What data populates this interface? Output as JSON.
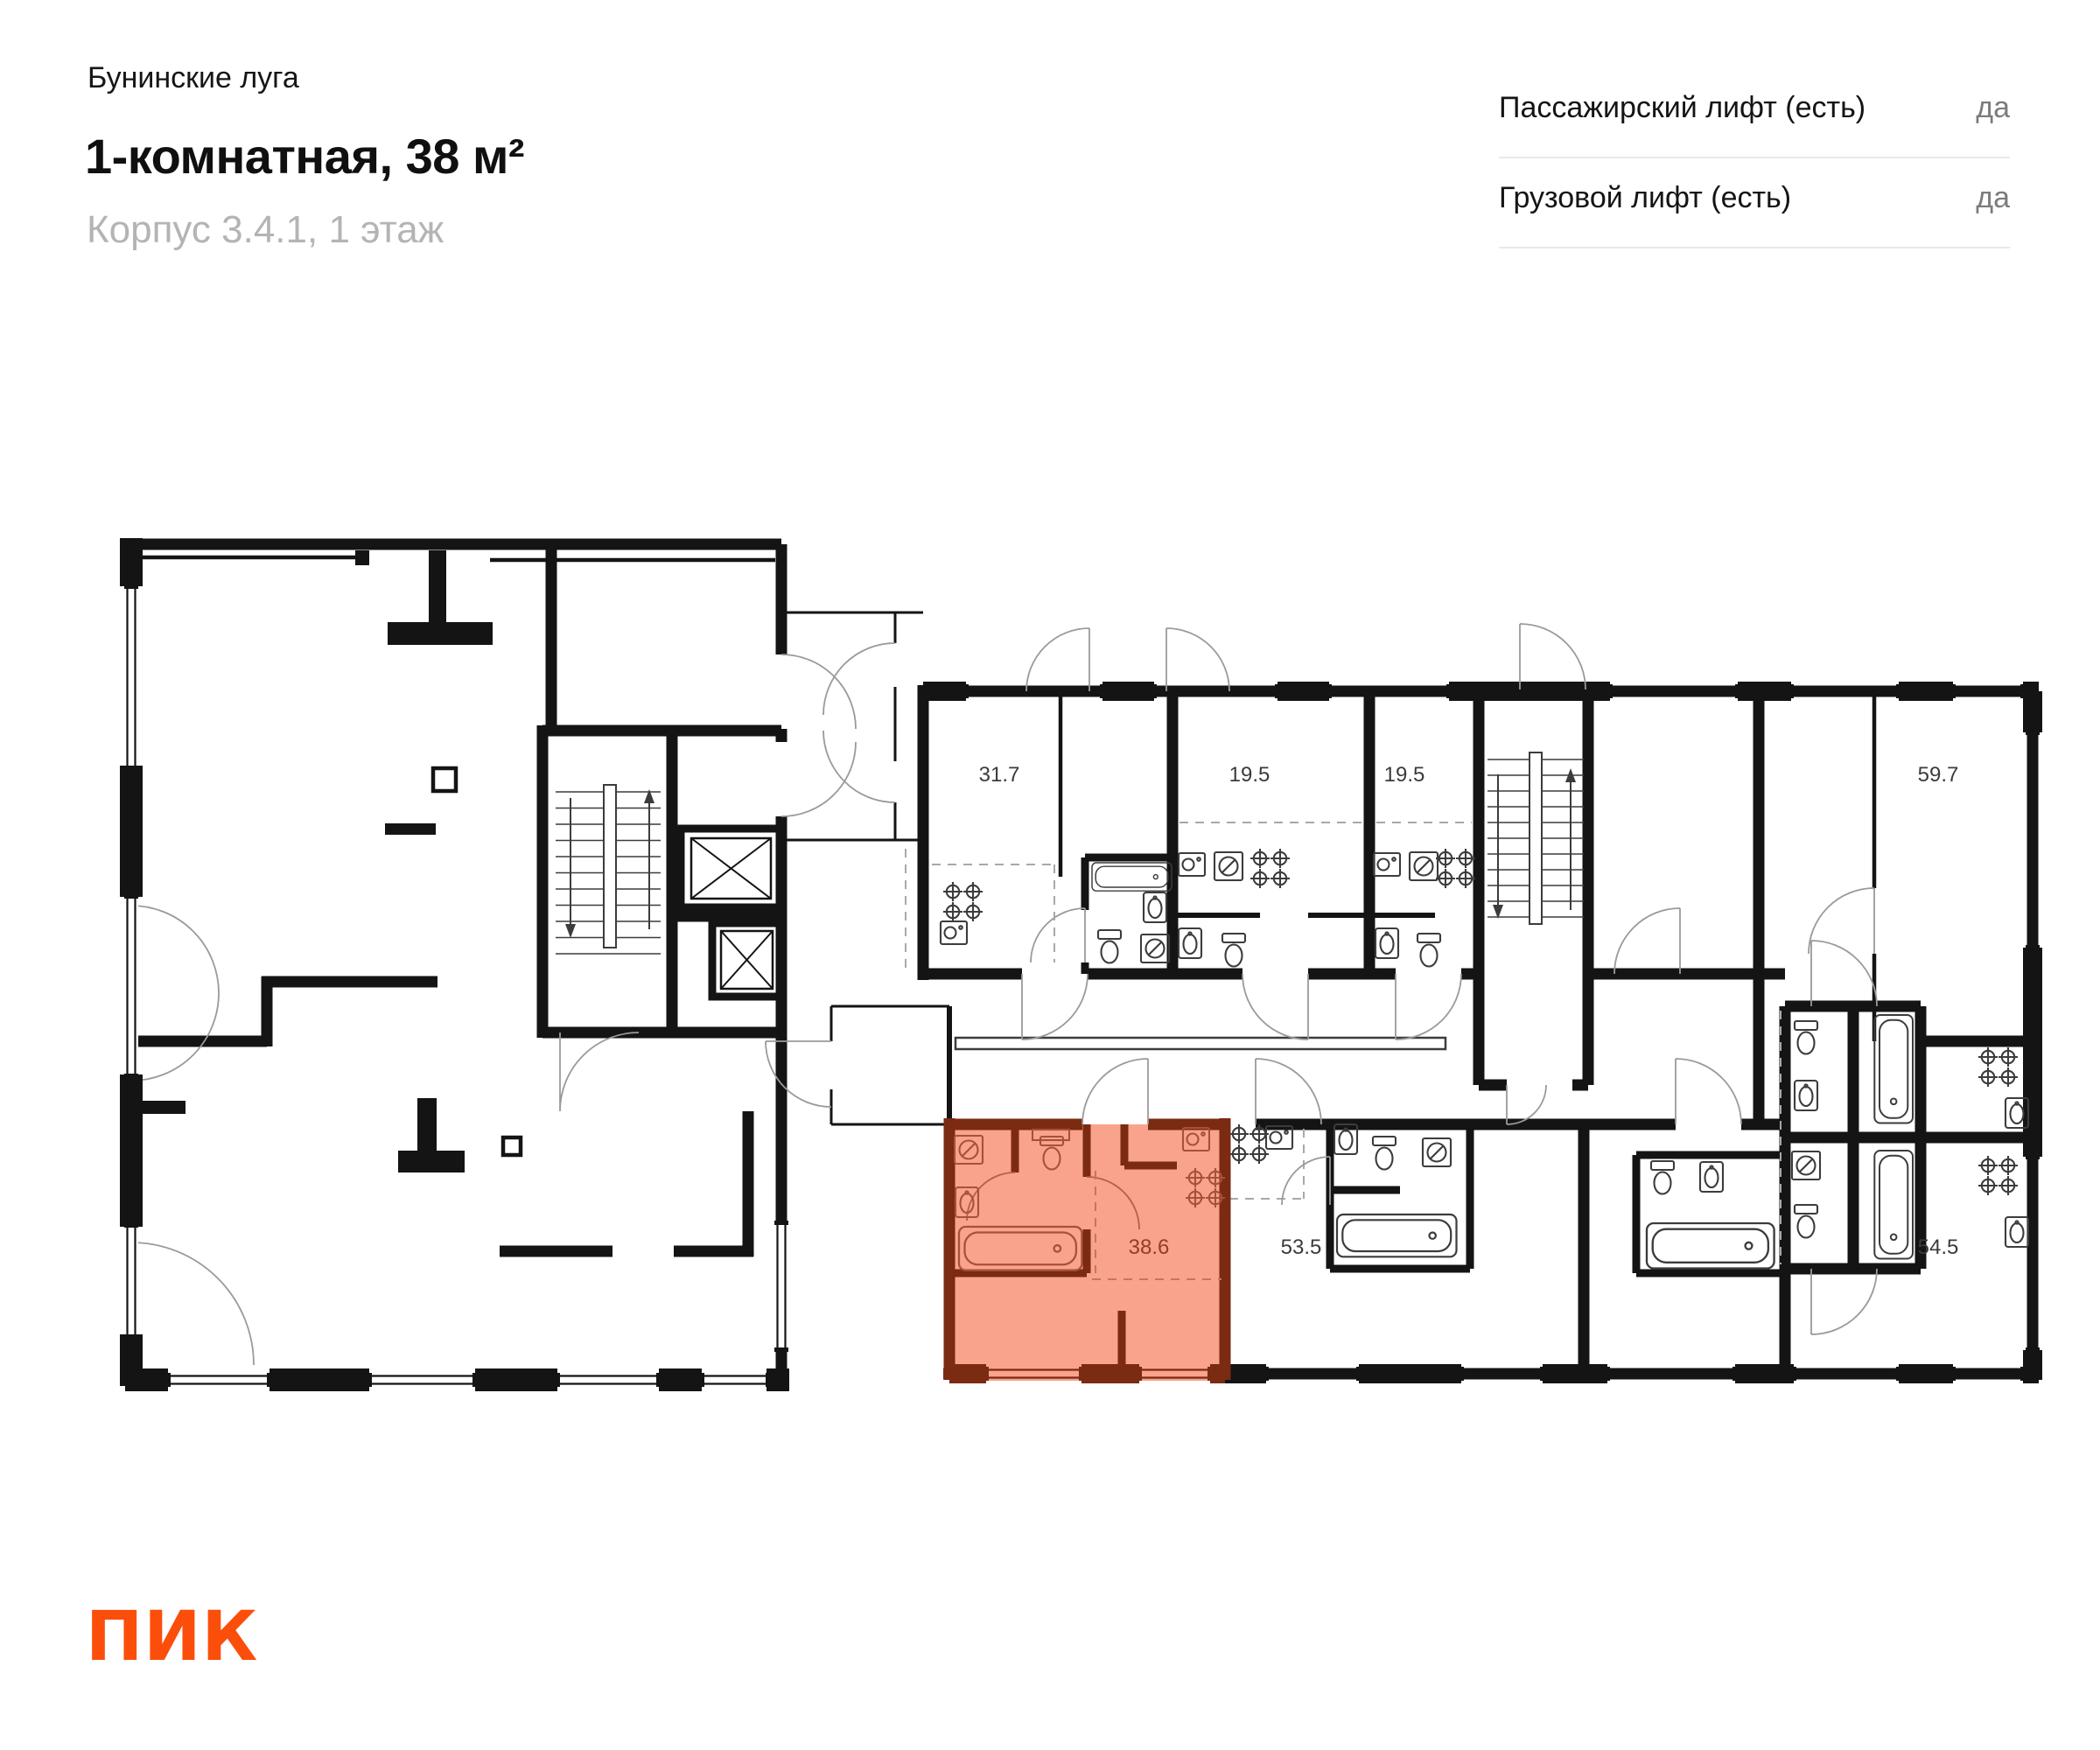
{
  "header": {
    "project_name": "Бунинские луга",
    "title": "1-комнатная, 38 м²",
    "subtitle": "Корпус 3.4.1, 1 этаж"
  },
  "lift_info": {
    "rows": [
      {
        "label": "Пассажирский лифт (есть)",
        "value": "да"
      },
      {
        "label": "Грузовой лифт (есть)",
        "value": "да"
      }
    ]
  },
  "plan": {
    "units": [
      {
        "area": "31.7",
        "highlighted": false
      },
      {
        "area": "19.5",
        "highlighted": false
      },
      {
        "area": "19.5",
        "highlighted": false
      },
      {
        "area": "59.7",
        "highlighted": false
      },
      {
        "area": "38.6",
        "highlighted": true
      },
      {
        "area": "53.5",
        "highlighted": false
      },
      {
        "area": "54.5",
        "highlighted": false
      }
    ],
    "highlight_colors": {
      "fill": "#F9A28C",
      "wall": "#7A2B12",
      "text": "#8F3E2B"
    }
  },
  "logo": {
    "text": "ПИК",
    "color": "#FB4E0B"
  }
}
